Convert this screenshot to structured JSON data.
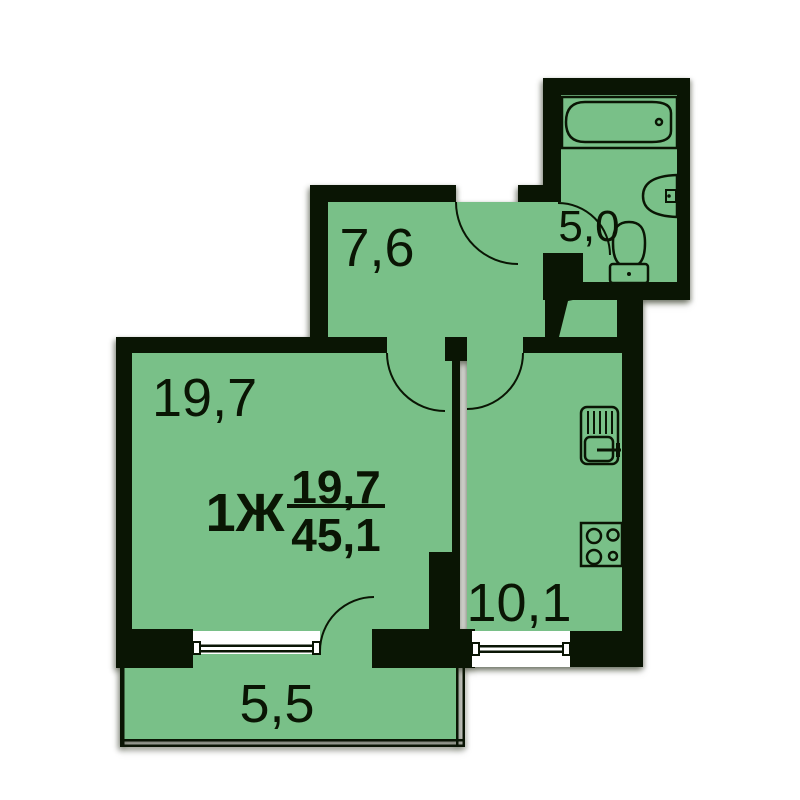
{
  "apartment": {
    "type_label": "1Ж",
    "living_area": "19,7",
    "total_area": "45,1"
  },
  "rooms": {
    "living": {
      "area": "19,7"
    },
    "hallway": {
      "area": "7,6"
    },
    "kitchen": {
      "area": "10,1"
    },
    "bathroom": {
      "area": "5,0"
    },
    "balcony": {
      "area": "5,5"
    }
  },
  "fixtures": {
    "bathroom": [
      "bathtub-icon",
      "wash-basin-icon",
      "toilet-icon"
    ],
    "kitchen": [
      "kitchen-sink-icon",
      "stove-icon"
    ]
  },
  "colors": {
    "room_fill": "#79c088",
    "wall": "#0a1504",
    "background": "#ffffff",
    "window": "#ffffff"
  }
}
